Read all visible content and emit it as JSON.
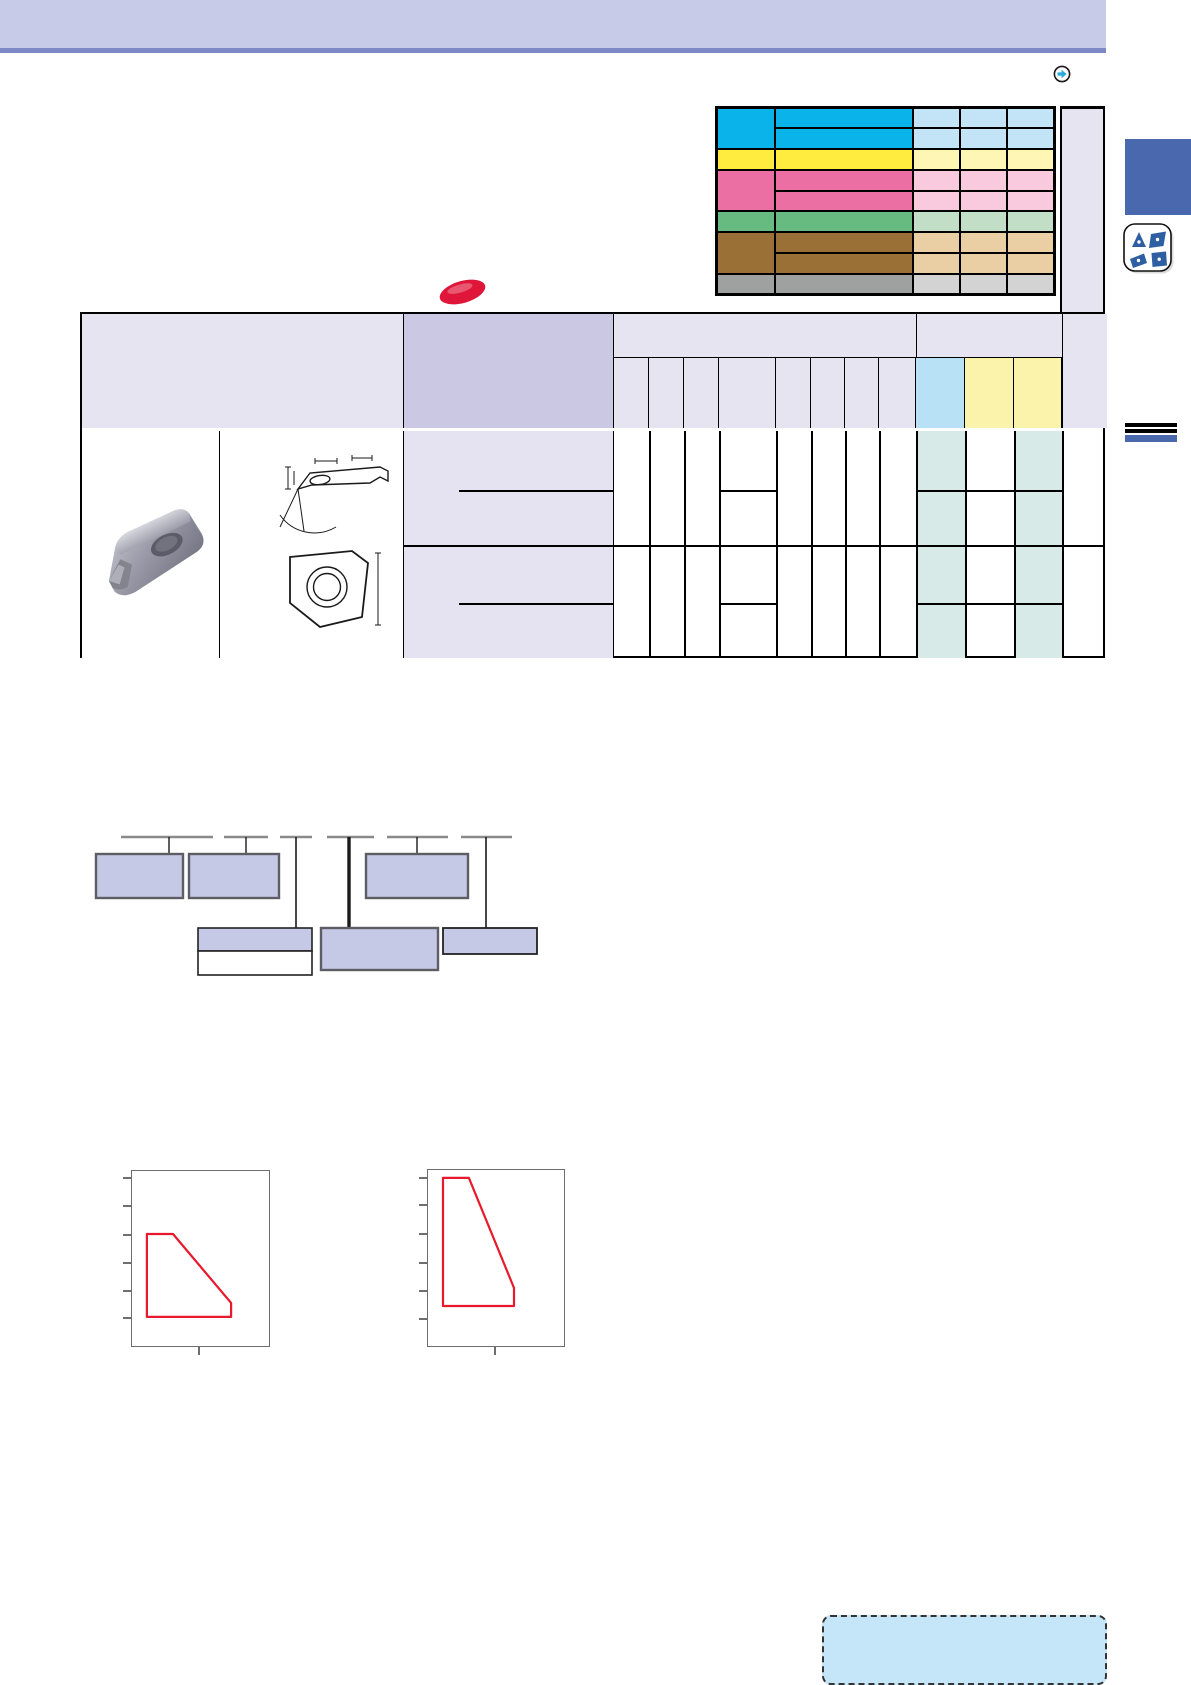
{
  "page": {
    "width": 1191,
    "height": 1662,
    "background": "#ffffff"
  },
  "header_bar": {
    "fill": "#c7cbe7",
    "underline_color": "#7d88c6"
  },
  "nav": {
    "next_arrow_color": "#29abe2"
  },
  "legend_table": {
    "outer_border_color": "#000000",
    "groups": [
      {
        "id": "cyan",
        "strong": "#0ab4ea",
        "light": "#c3e3f7",
        "sub_rows": 2
      },
      {
        "id": "yellow",
        "strong": "#ffec3e",
        "light": "#fdf6b4",
        "sub_rows": 1
      },
      {
        "id": "pink",
        "strong": "#ec6fa4",
        "light": "#f9c9de",
        "sub_rows": 2
      },
      {
        "id": "green",
        "strong": "#68bb80",
        "light": "#c3dec6",
        "sub_rows": 1
      },
      {
        "id": "brown",
        "strong": "#9a7036",
        "light": "#eacfa4",
        "sub_rows": 2
      },
      {
        "id": "gray",
        "strong": "#9fa0a0",
        "light": "#d3d3d4",
        "sub_rows": 1
      }
    ]
  },
  "side_panel": {
    "blue_square_color": "#4a68ae",
    "insert_shapes_icon": {
      "shape_color": "#2e5fa3",
      "background": "#ffffff"
    }
  },
  "badge": {
    "color": "#e0153a"
  },
  "main_table": {
    "header_fill": "#e6e4f1",
    "designation_header_fill": "#cbc8e3",
    "designation_cell_fill": "#e5e3f2",
    "stock_col_blue_fill": "#b9e1f6",
    "stock_col_yellow_fill": "#fbf3ac",
    "stocked_cell_fill": "#d7eae7",
    "grid_color": "#000000"
  },
  "insert_photo_palette": {
    "light": "#cacad4",
    "mid": "#9a9aa8",
    "dark": "#5c5c68"
  },
  "section_marker": {
    "rule_color": "#000000",
    "bar_color": "#4a68ae"
  },
  "designation_tree": {
    "box_fill": "#c6c9e5",
    "box_border": "#5d5d66",
    "ruler_color": "#8a8a8a",
    "connector_color": "#1a1a1a"
  },
  "chart_data": [
    {
      "type": "area",
      "title": "",
      "xlabel": "",
      "ylabel": "",
      "x_axis": {
        "visible_tick_count": 1,
        "labels": []
      },
      "y_axis": {
        "visible_tick_count": 6,
        "labels": []
      },
      "grid": false,
      "line_color": "#e8192c",
      "polygon": [
        [
          0.109,
          0.64
        ],
        [
          0.299,
          0.64
        ],
        [
          0.723,
          0.246
        ],
        [
          0.723,
          0.166
        ],
        [
          0.109,
          0.166
        ]
      ],
      "description": "left application-range envelope (no axis labels printed)"
    },
    {
      "type": "area",
      "title": "",
      "xlabel": "",
      "ylabel": "",
      "x_axis": {
        "visible_tick_count": 1,
        "labels": []
      },
      "y_axis": {
        "visible_tick_count": 6,
        "labels": []
      },
      "grid": false,
      "line_color": "#e8192c",
      "polygon": [
        [
          0.11,
          0.955
        ],
        [
          0.301,
          0.955
        ],
        [
          0.632,
          0.33
        ],
        [
          0.632,
          0.227
        ],
        [
          0.11,
          0.227
        ]
      ],
      "description": "right application-range envelope (no axis labels printed)"
    }
  ],
  "note_box": {
    "fill": "#c5e6f9",
    "border_color": "#333333"
  }
}
